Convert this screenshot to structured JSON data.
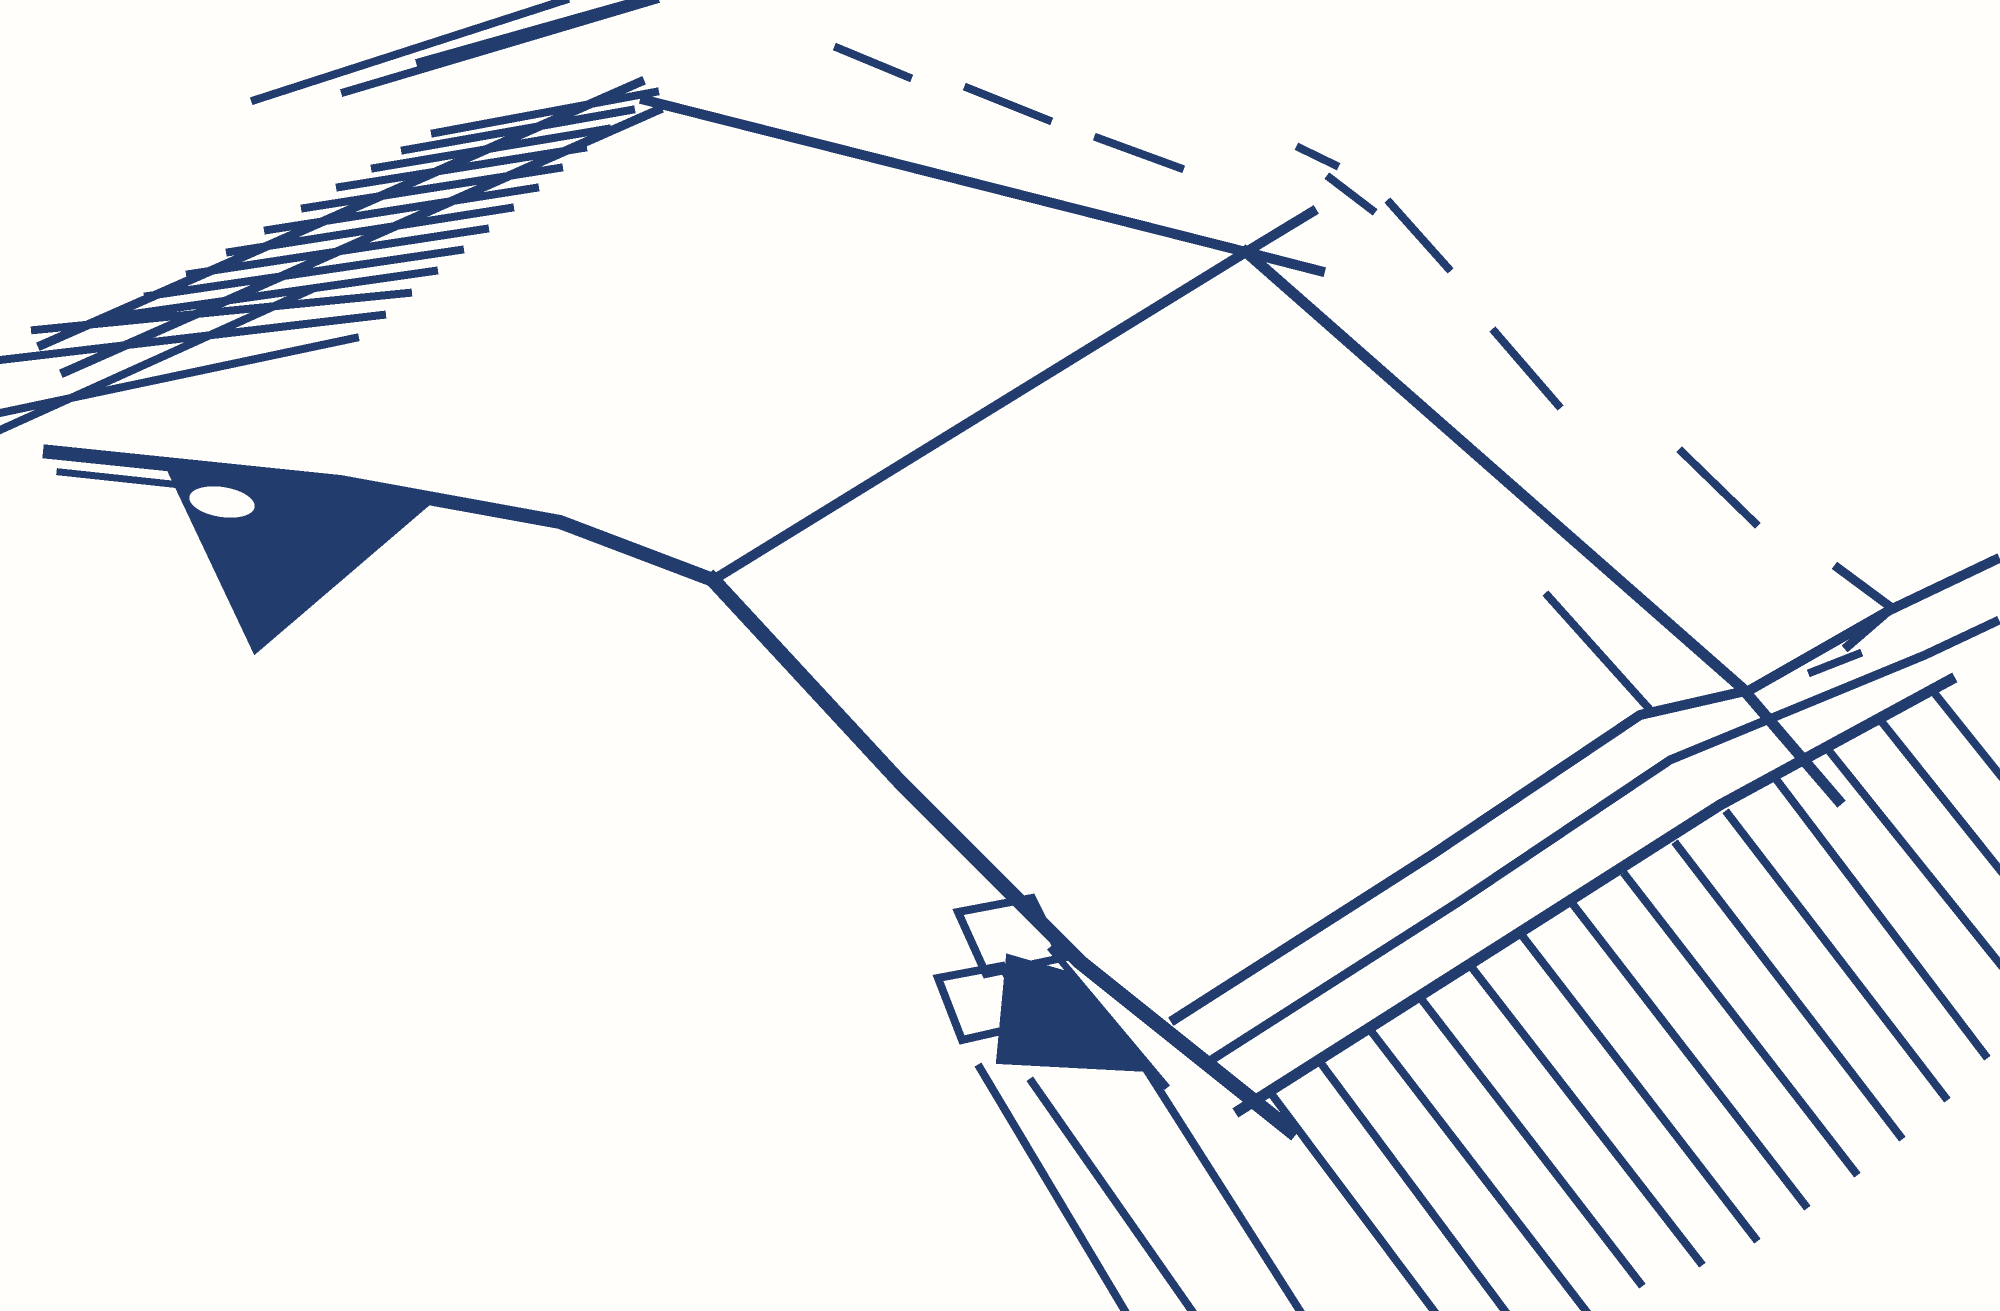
{
  "meta": {
    "subject": "integrated-circuit-package-line-drawing",
    "description": "Pixelated navy line sketch of a dual-in-line IC chip package in perspective with two fans of leads"
  },
  "canvas": {
    "width": 2000,
    "height": 1311,
    "background": "#FFFEFB",
    "ink": "#223C6E"
  },
  "illustration": {
    "strokes": [
      {
        "name": "rail-top-1",
        "w": 9,
        "pts": [
          [
            42,
            345
          ],
          [
            640,
            82
          ]
        ]
      },
      {
        "name": "rail-top-2",
        "w": 9,
        "pts": [
          [
            65,
            372
          ],
          [
            658,
            110
          ]
        ]
      },
      {
        "name": "rail-top-3",
        "w": 8,
        "pts": [
          [
            0,
            430
          ],
          [
            310,
            290
          ]
        ]
      },
      {
        "name": "body-top-edge",
        "w": 10,
        "pts": [
          [
            645,
            100
          ],
          [
            1246,
            252
          ],
          [
            1320,
            271
          ]
        ]
      },
      {
        "name": "body-left-top-edge",
        "w": 10,
        "pts": [
          [
            713,
            580
          ],
          [
            1246,
            252
          ],
          [
            1312,
            212
          ]
        ]
      },
      {
        "name": "body-right-edge",
        "w": 11,
        "pts": [
          [
            1246,
            252
          ],
          [
            1742,
            688
          ],
          [
            1838,
            800
          ]
        ]
      },
      {
        "name": "overdraw-stroke",
        "w": 8,
        "pts": [
          [
            1548,
            596
          ],
          [
            1652,
            712
          ]
        ]
      },
      {
        "name": "body-left-bottom-edge",
        "w": 15,
        "pts": [
          [
            713,
            580
          ],
          [
            900,
            782
          ],
          [
            1080,
            962
          ],
          [
            1290,
            1130
          ]
        ]
      },
      {
        "name": "inner-edge-line",
        "w": 7,
        "pts": [
          [
            1052,
            950
          ],
          [
            1165,
            1085
          ]
        ]
      },
      {
        "name": "rail-bottom-1",
        "w": 10,
        "pts": [
          [
            1175,
            1019
          ],
          [
            1430,
            856
          ],
          [
            1640,
            715
          ],
          [
            1750,
            690
          ],
          [
            1890,
            610
          ],
          [
            1995,
            560
          ]
        ]
      },
      {
        "name": "rail-bottom-2",
        "w": 9,
        "pts": [
          [
            1205,
            1064
          ],
          [
            1460,
            901
          ],
          [
            1670,
            760
          ],
          [
            1925,
            655
          ],
          [
            1995,
            622
          ]
        ]
      },
      {
        "name": "rail-bottom-3",
        "w": 11,
        "pts": [
          [
            1240,
            1110
          ],
          [
            1500,
            945
          ],
          [
            1720,
            805
          ],
          [
            1950,
            680
          ]
        ]
      },
      {
        "name": "left-band",
        "w": 14,
        "pts": [
          [
            50,
            452
          ],
          [
            340,
            482
          ],
          [
            560,
            522
          ],
          [
            713,
            580
          ]
        ]
      },
      {
        "name": "left-band-inner",
        "w": 7,
        "pts": [
          [
            60,
            472
          ],
          [
            348,
            503
          ]
        ]
      },
      {
        "name": "skirt-line-1",
        "w": 8,
        "pts": [
          [
            980,
            1068
          ],
          [
            1125,
            1311
          ]
        ]
      },
      {
        "name": "skirt-line-2",
        "w": 8,
        "pts": [
          [
            1032,
            1082
          ],
          [
            1192,
            1311
          ]
        ]
      },
      {
        "name": "skirt-line-3",
        "w": 8,
        "pts": [
          [
            1148,
            1072
          ],
          [
            1300,
            1311
          ]
        ]
      },
      {
        "name": "pin-top-1",
        "w": 8,
        "pts": [
          [
            0,
            413
          ],
          [
            355,
            338
          ]
        ]
      },
      {
        "name": "pin-top-2",
        "w": 8,
        "pts": [
          [
            0,
            360
          ],
          [
            382,
            315
          ]
        ]
      },
      {
        "name": "pin-top-3",
        "w": 8,
        "pts": [
          [
            35,
            330
          ],
          [
            408,
            293
          ]
        ]
      },
      {
        "name": "pin-top-4",
        "w": 8,
        "pts": [
          [
            105,
            318
          ],
          [
            434,
            271
          ]
        ]
      },
      {
        "name": "pin-top-5",
        "w": 8,
        "pts": [
          [
            148,
            296
          ],
          [
            460,
            250
          ]
        ]
      },
      {
        "name": "pin-top-6",
        "w": 8,
        "pts": [
          [
            190,
            274
          ],
          [
            485,
            229
          ]
        ]
      },
      {
        "name": "pin-top-7",
        "w": 8,
        "pts": [
          [
            230,
            252
          ],
          [
            510,
            208
          ]
        ]
      },
      {
        "name": "pin-top-8",
        "w": 8,
        "pts": [
          [
            268,
            230
          ],
          [
            535,
            188
          ]
        ]
      },
      {
        "name": "pin-top-9",
        "w": 8,
        "pts": [
          [
            305,
            208
          ],
          [
            559,
            168
          ]
        ]
      },
      {
        "name": "pin-top-10",
        "w": 8,
        "pts": [
          [
            340,
            187
          ],
          [
            583,
            148
          ]
        ]
      },
      {
        "name": "pin-top-11",
        "w": 8,
        "pts": [
          [
            375,
            168
          ],
          [
            607,
            129
          ]
        ]
      },
      {
        "name": "pin-top-12",
        "w": 8,
        "pts": [
          [
            405,
            150
          ],
          [
            631,
            110
          ]
        ]
      },
      {
        "name": "pin-top-13",
        "w": 8,
        "pts": [
          [
            435,
            133
          ],
          [
            655,
            92
          ]
        ]
      },
      {
        "name": "pin-stub-top-1",
        "w": 8,
        "pts": [
          [
            255,
            100
          ],
          [
            565,
            0
          ]
        ]
      },
      {
        "name": "pin-stub-top-2",
        "w": 8,
        "pts": [
          [
            345,
            92
          ],
          [
            655,
            0
          ]
        ]
      },
      {
        "name": "pin-stub-top-3",
        "w": 8,
        "pts": [
          [
            420,
            62
          ],
          [
            640,
            0
          ]
        ]
      },
      {
        "name": "pin-bottom-0",
        "w": 8,
        "pts": [
          [
            1270,
            1092
          ],
          [
            1434,
            1311
          ]
        ]
      },
      {
        "name": "pin-bottom-1",
        "w": 8,
        "pts": [
          [
            1320,
            1062
          ],
          [
            1505,
            1311
          ]
        ]
      },
      {
        "name": "pin-bottom-2",
        "w": 8,
        "pts": [
          [
            1371,
            1031
          ],
          [
            1586,
            1311
          ]
        ]
      },
      {
        "name": "pin-bottom-3",
        "w": 8,
        "pts": [
          [
            1422,
            1000
          ],
          [
            1640,
            1283
          ]
        ]
      },
      {
        "name": "pin-bottom-4",
        "w": 8,
        "pts": [
          [
            1473,
            969
          ],
          [
            1700,
            1262
          ]
        ]
      },
      {
        "name": "pin-bottom-5",
        "w": 8,
        "pts": [
          [
            1524,
            938
          ],
          [
            1755,
            1238
          ]
        ]
      },
      {
        "name": "pin-bottom-6",
        "w": 8,
        "pts": [
          [
            1575,
            907
          ],
          [
            1805,
            1205
          ]
        ]
      },
      {
        "name": "pin-bottom-7",
        "w": 8,
        "pts": [
          [
            1626,
            876
          ],
          [
            1855,
            1172
          ]
        ]
      },
      {
        "name": "pin-bottom-8",
        "w": 8,
        "pts": [
          [
            1677,
            845
          ],
          [
            1900,
            1136
          ]
        ]
      },
      {
        "name": "pin-bottom-9",
        "w": 8,
        "pts": [
          [
            1728,
            814
          ],
          [
            1945,
            1097
          ]
        ]
      },
      {
        "name": "pin-bottom-10",
        "w": 8,
        "pts": [
          [
            1779,
            783
          ],
          [
            1985,
            1055
          ]
        ]
      },
      {
        "name": "pin-bottom-11",
        "w": 8,
        "pts": [
          [
            1830,
            752
          ],
          [
            2000,
            964
          ]
        ]
      },
      {
        "name": "pin-bottom-12",
        "w": 8,
        "pts": [
          [
            1881,
            721
          ],
          [
            2000,
            870
          ]
        ]
      },
      {
        "name": "pin-bottom-13",
        "w": 8,
        "pts": [
          [
            1932,
            690
          ],
          [
            2000,
            775
          ]
        ]
      },
      {
        "name": "hidden-dash-1",
        "w": 8,
        "pts": [
          [
            838,
            48
          ],
          [
            908,
            77
          ]
        ]
      },
      {
        "name": "hidden-dash-2",
        "w": 8,
        "pts": [
          [
            968,
            88
          ],
          [
            1048,
            120
          ]
        ]
      },
      {
        "name": "hidden-dash-3",
        "w": 8,
        "pts": [
          [
            1098,
            138
          ],
          [
            1180,
            168
          ]
        ]
      },
      {
        "name": "hidden-dash-4",
        "w": 8,
        "pts": [
          [
            1300,
            148
          ],
          [
            1335,
            165
          ]
        ]
      },
      {
        "name": "hidden-dash-5",
        "w": 8,
        "pts": [
          [
            1330,
            178
          ],
          [
            1372,
            210
          ]
        ]
      },
      {
        "name": "hidden-dash-6",
        "w": 8,
        "pts": [
          [
            1390,
            203
          ],
          [
            1448,
            268
          ]
        ]
      },
      {
        "name": "hidden-dash-7",
        "w": 8,
        "pts": [
          [
            1495,
            332
          ],
          [
            1558,
            405
          ]
        ]
      },
      {
        "name": "hidden-dash-8",
        "w": 8,
        "pts": [
          [
            1682,
            452
          ],
          [
            1755,
            523
          ]
        ]
      },
      {
        "name": "hidden-corner-hook",
        "w": 9,
        "pts": [
          [
            1838,
            568
          ],
          [
            1892,
            608
          ],
          [
            1848,
            646
          ]
        ]
      },
      {
        "name": "hidden-dash-9",
        "w": 8,
        "pts": [
          [
            1812,
            672
          ],
          [
            1858,
            654
          ]
        ]
      }
    ],
    "outlines": [
      {
        "name": "end-tab-outline-1",
        "w": 8,
        "pts": [
          [
            958,
            912
          ],
          [
            1032,
            898
          ],
          [
            1062,
            958
          ],
          [
            986,
            974
          ]
        ]
      },
      {
        "name": "end-tab-outline-2",
        "w": 8,
        "pts": [
          [
            938,
            978
          ],
          [
            1002,
            966
          ],
          [
            1032,
            1024
          ],
          [
            962,
            1040
          ]
        ]
      }
    ],
    "fills": [
      {
        "name": "end-cap-wedge-left",
        "pts": [
          [
            168,
            468
          ],
          [
            435,
            498
          ],
          [
            255,
            652
          ]
        ]
      },
      {
        "name": "end-cap-wedge-bottom",
        "pts": [
          [
            1008,
            956
          ],
          [
            1070,
            974
          ],
          [
            1148,
            1070
          ],
          [
            998,
            1062
          ]
        ]
      }
    ],
    "holes": [
      {
        "name": "end-cap-notch",
        "cx": 222,
        "cy": 502,
        "rx": 33,
        "ry": 15,
        "rot": 9
      }
    ]
  }
}
